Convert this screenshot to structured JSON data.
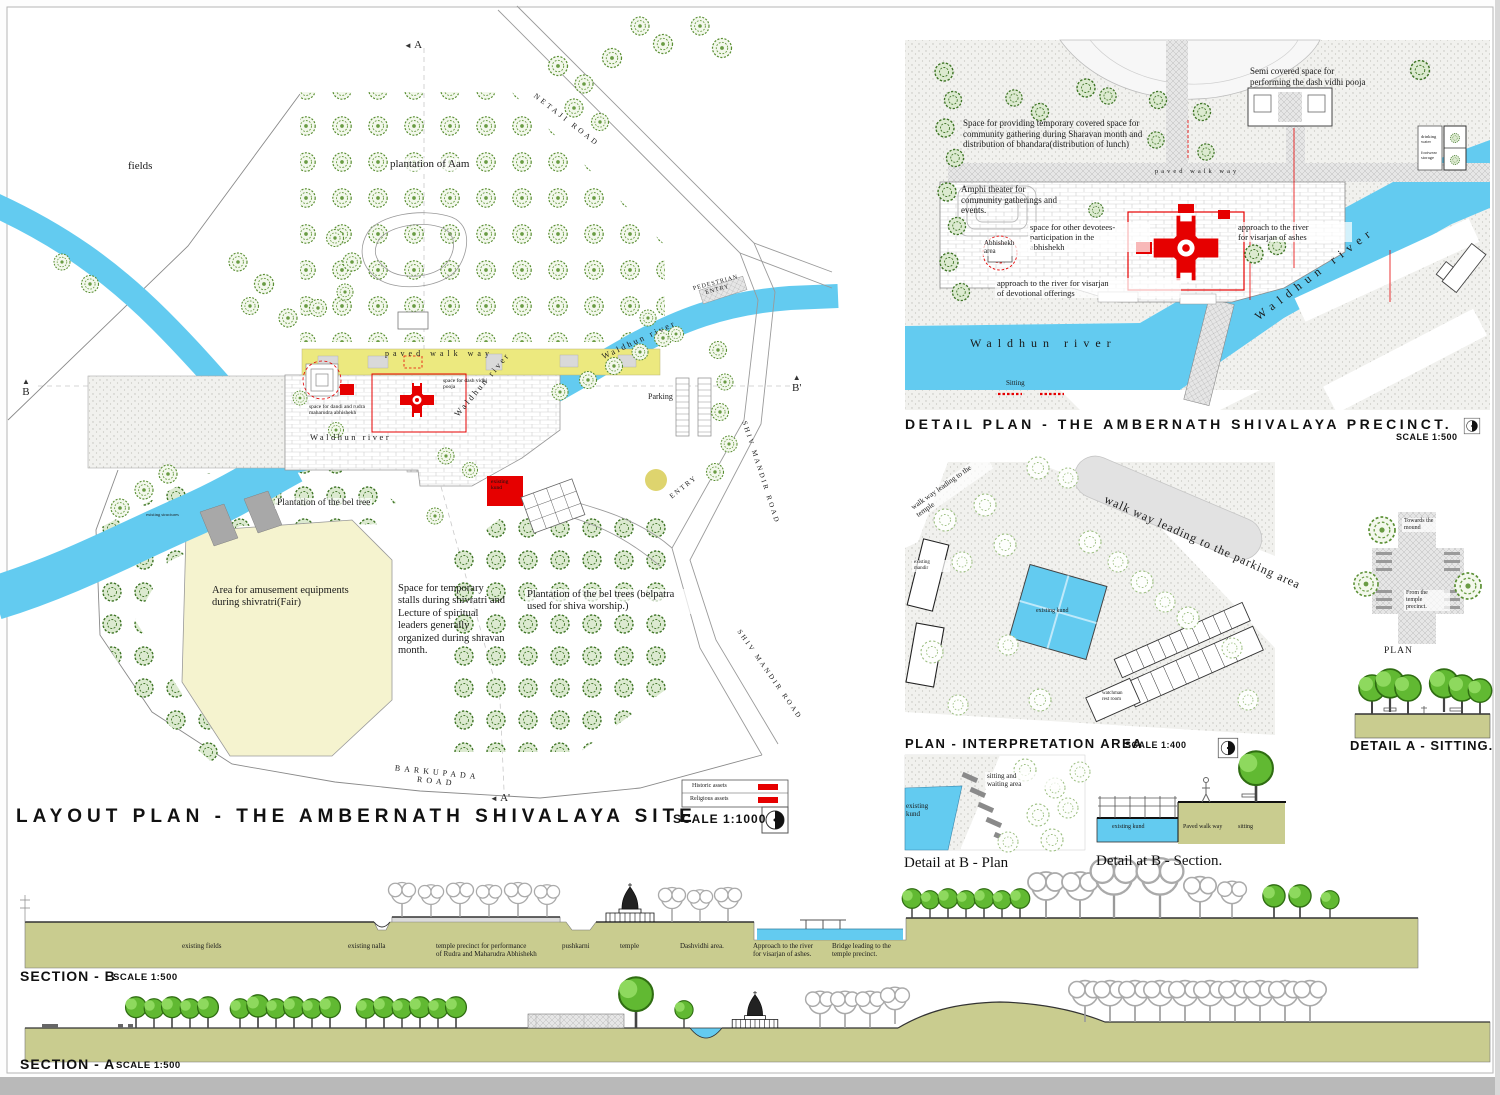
{
  "colors": {
    "river": "#63cbf0",
    "historic_red": "#e60000",
    "ground_olive": "#c9cc8f",
    "walkway_yellow": "#ece97f",
    "fair_yellow": "#f5f3cf",
    "tree_green": "#5a8f33"
  },
  "layout_plan": {
    "title": "LAYOUT PLAN - THE AMBERNATH SHIVALAYA SITE",
    "scale": "SCALE 1:1000",
    "markers": {
      "a": "A",
      "a_prime": "A'",
      "b": "B",
      "b_prime": "B'"
    },
    "legend": {
      "historic": "Historic assets",
      "religious": "Religious assets"
    },
    "labels": {
      "fields": "fields",
      "plantation_aam": "plantation of Aam",
      "netaji_road": "NETAJI ROAD",
      "pedestrian_entry": "PEDESTRIAN\nENTRY",
      "paved_walk_way": "paved walk way",
      "dash_vidhi": "space for dash vidhi\npooja",
      "dandi": "space for dandi and rudra\nmaharudra abhishekh",
      "waldhun_river": "Waldhun river",
      "parking": "Parking",
      "entry": "ENTRY",
      "shiv_mandir_road": "SHIV MANDIR ROAD",
      "barkupada_road": "BARKUPADA\nROAD",
      "existing_kund": "existing\nkund",
      "existing_structures": "existing structures",
      "amusement": "Area for amusement equipments\nduring shivratri(Fair)",
      "stalls": "Space for temporary\nstalls during shivratri and\nLecture of spiritual\nleaders generally\norganized during shravan\nmonth.",
      "bel_tree": "Plantation of the bel tree",
      "bel_trees": "Plantation of the bel trees (belpatra\nused for shiva worship.)"
    }
  },
  "detail_plan": {
    "title": "DETAIL PLAN - THE AMBERNATH SHIVALAYA PRECINCT.",
    "scale": "SCALE 1:500",
    "labels": {
      "semi_covered": "Semi covered space for\nperforming the dash vidhi pooja",
      "community": "Space for providing temporary covered space for\ncommunity gathering during Sharavan month and\ndistribution of bhandara(distribution of lunch)",
      "amphi": "Amphi theater for\ncommunity gatherings and\nevents.",
      "devotees": "space for other devotees-\nparticipation in the\nabhishekh",
      "approach_ashes": "approach to the river\nfor visarjan of ashes",
      "abhishekh_area": "Abhishekh\narea",
      "approach_offerings": "approach to the river for visarjan\nof devotional offerings",
      "paved_walk_way": "paved walk way",
      "waldhun_river": "Waldhun river",
      "sitting": "Sitting",
      "drinking_water": "drinking\nwater",
      "footwear_storage": "footwear\nstorage"
    }
  },
  "interpretation_plan": {
    "title": "PLAN - INTERPRETATION AREA",
    "scale": "SCALE 1:400",
    "labels": {
      "walkway_temple": "walk way leading to the\ntemple",
      "walkway_parking": "walk way leading to the parking area",
      "existing_kund": "existing kund",
      "existing_mandir": "existing\nmandir",
      "watchman": "watchman\nrest room"
    }
  },
  "detail_a": {
    "title": "DETAIL A -  SITTING.",
    "labels": {
      "towards_mound": "Towards the\nmound",
      "from_precinct": "From the\ntemple\nprecinct.",
      "plan": "PLAN"
    }
  },
  "detail_b": {
    "plan_caption": "Detail at B - Plan",
    "section_caption": "Detail at B - Section.",
    "labels": {
      "sitting_waiting": "sitting and\nwaiting area",
      "existing_kund_plan": "existing\nkund",
      "existing_kund_section": "existing kund",
      "paved_walk_way": "Paved walk way",
      "sitting": "sitting"
    }
  },
  "section_b": {
    "caption": "SECTION - B",
    "scale": "SCALE 1:500",
    "labels": {
      "fields": "existing fields",
      "nalla": "existing nalla",
      "precinct": "temple precinct for performance\nof Rudra and Maharudra Abhishekh",
      "pushkarni": "pushkarni",
      "temple": "temple",
      "dashvidhi": "Dashvidhi area.",
      "approach": "Approach to the river\nfor visarjan of ashes.",
      "bridge": "Bridge leading to the\ntemple precinct."
    }
  },
  "section_a": {
    "caption": "SECTION - A",
    "scale": "SCALE 1:500"
  }
}
